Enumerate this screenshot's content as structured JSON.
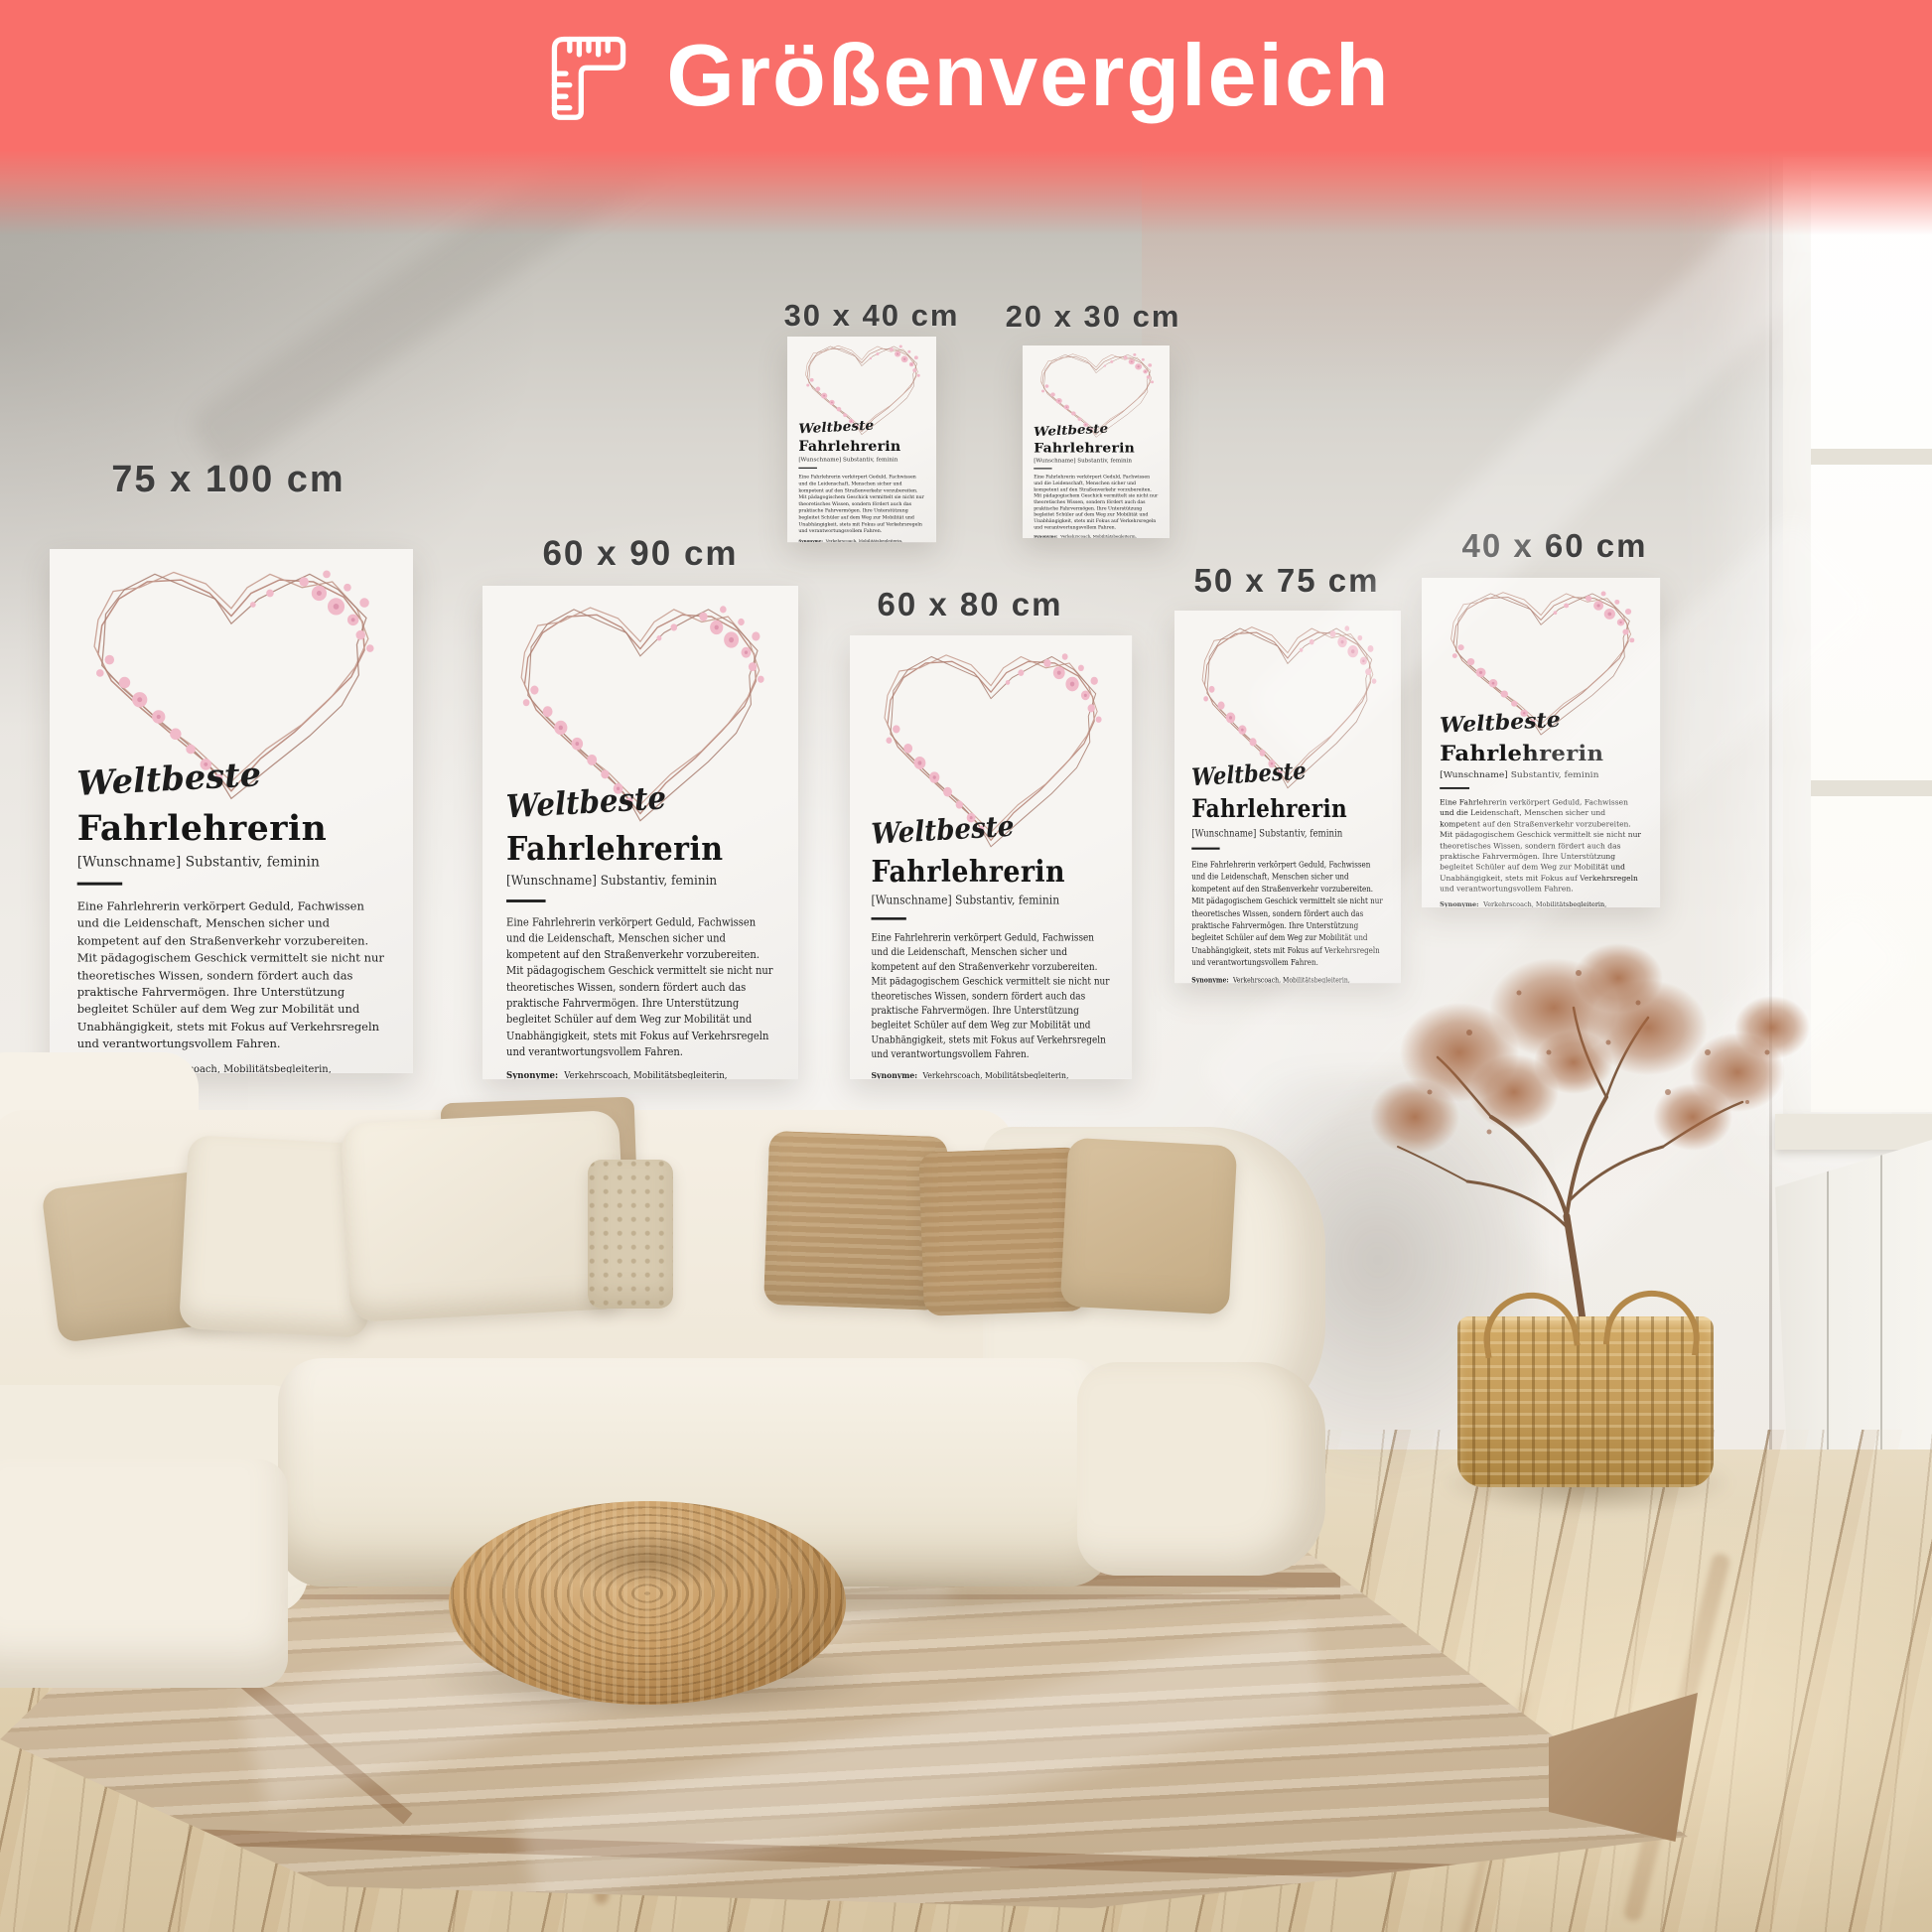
{
  "banner": {
    "title": "Größenvergleich",
    "background_color": "#f96f6a",
    "icon": "folding-ruler-icon"
  },
  "sizes": [
    {
      "label": "75 x 100 cm"
    },
    {
      "label": "60 x 90 cm"
    },
    {
      "label": "30 x 40 cm"
    },
    {
      "label": "20 x 30 cm"
    },
    {
      "label": "60 x 80 cm"
    },
    {
      "label": "50 x 75 cm"
    },
    {
      "label": "40 x 60 cm"
    }
  ],
  "poster": {
    "script_title": "Weltbeste",
    "title": "Fahrlehrerin",
    "subtitle": "[Wunschname] Substantiv, feminin",
    "description": "Eine Fahrlehrerin verkörpert Geduld, Fachwissen und die Leidenschaft, Menschen sicher und kompetent auf den Straßenverkehr vorzubereiten. Mit pädagogischem Geschick vermittelt sie nicht nur theoretisches Wissen, sondern fördert auch das praktische Fahrvermögen. Ihre Unterstützung begleitet Schüler auf dem Weg zur Mobilität und Unabhängigkeit, stets mit Fokus auf Verkehrsregeln und verantwortungsvollem Fahren.",
    "synonyms_label": "Synonyme:",
    "synonyms": "Verkehrscoach, Mobilitätsbegleiterin, Fahrkompetenzvermittlerin, Wegweiserin auf Rädern."
  },
  "colors": {
    "banner": "#f96f6a",
    "heart_stroke": "#b98a7d",
    "flower_pink": "#f0bac9",
    "size_label_text": "#3e3e3e",
    "poster_background": "#f6f4f1"
  }
}
